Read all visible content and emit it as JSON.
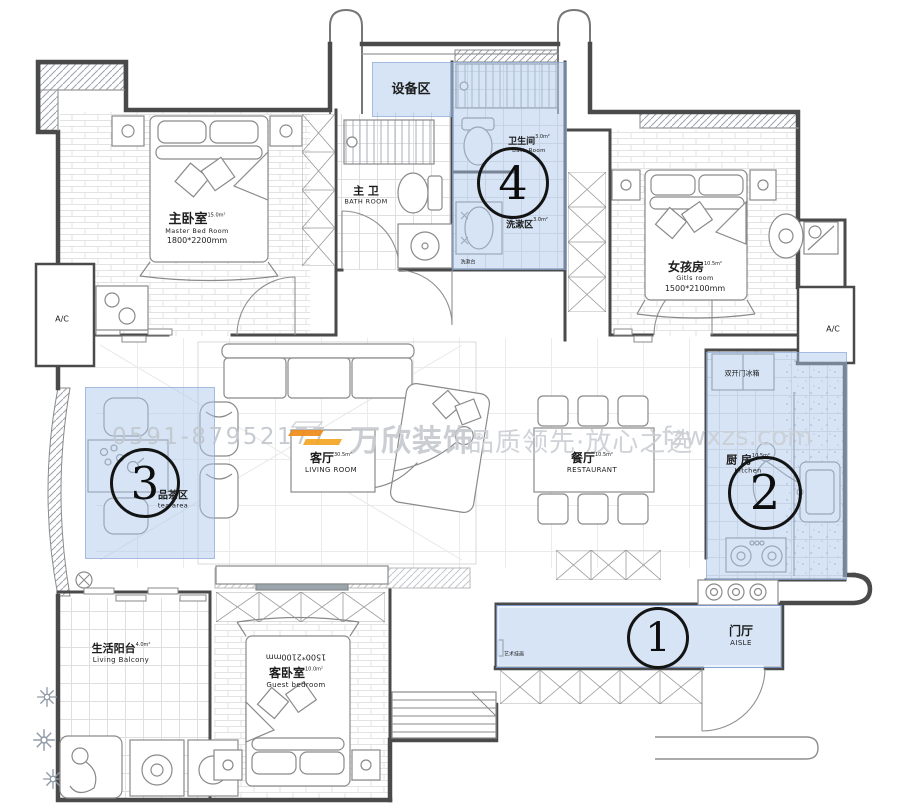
{
  "watermark": {
    "phone": "0591-87952177",
    "brand": "万欣装饰",
    "registered": "®",
    "slogan": "品质领先·放心之选",
    "url": "fzwxzs.com"
  },
  "markers": {
    "m1": "1",
    "m2": "2",
    "m3": "3",
    "m4": "4"
  },
  "rooms": {
    "equipment_area": {
      "zh": "设备区"
    },
    "master_bedroom": {
      "zh": "主卧室",
      "area": "15.0m²",
      "en": "Master Bed Room",
      "dim": "1800*2200mm"
    },
    "master_bath": {
      "zh": "主 卫",
      "en": "BATH ROOM"
    },
    "bathroom": {
      "zh": "卫生间",
      "area": "3.0m²",
      "en": "Bath Room"
    },
    "wash_area": {
      "zh": "洗漱区",
      "area": "3.0m²"
    },
    "girls_room": {
      "zh": "女孩房",
      "area": "10.5m²",
      "en": "Gitls room",
      "dim": "1500*2100mm"
    },
    "ac_left": {
      "label": "A/C"
    },
    "ac_right": {
      "label": "A/C"
    },
    "tea_area": {
      "zh": "品茶区",
      "en": "tea area"
    },
    "living_room": {
      "zh": "客厅",
      "area": "30.5m²",
      "en": "LIVING ROOM"
    },
    "dining_room": {
      "zh": "餐厅",
      "area": "10.5m²",
      "en": "RESTAURANT"
    },
    "kitchen": {
      "zh": "厨 房",
      "area": "10.5m²",
      "en": "Kitchen"
    },
    "fridge": {
      "zh": "双开门冰箱"
    },
    "living_balcony": {
      "zh": "生活阳台",
      "area": "4.0m²",
      "en": "Living Balcony"
    },
    "guest_bedroom": {
      "zh": "客卧室",
      "area": "10.0m²",
      "en": "Guest bedroom",
      "dim": "1500*2100mm"
    },
    "aisle": {
      "zh": "门厅",
      "en": "AISLE"
    },
    "art_painting": {
      "zh": "艺术挂画"
    },
    "wash_counter": {
      "zh": "洗漱台"
    }
  },
  "colors": {
    "highlight": "rgba(170,198,235,0.48)",
    "accent": "#f08a1a",
    "wall": "#4a4a4a"
  }
}
